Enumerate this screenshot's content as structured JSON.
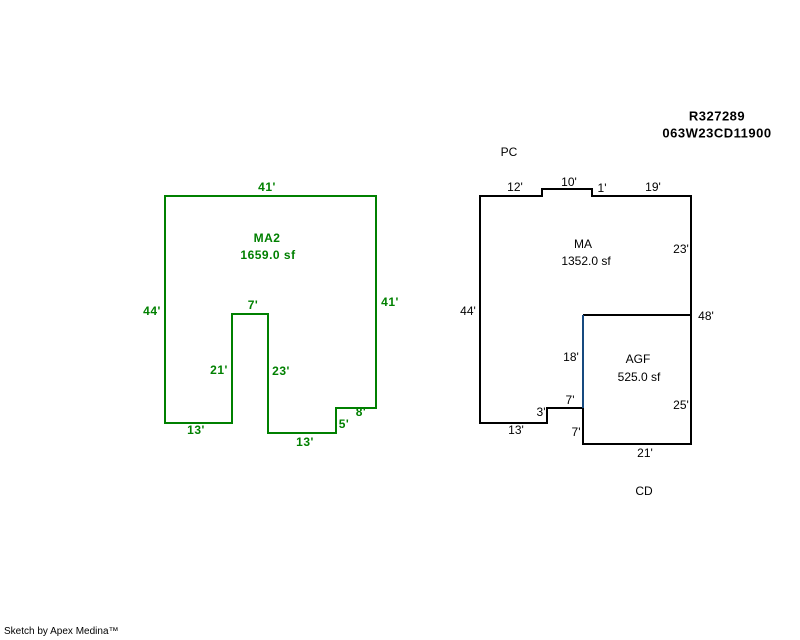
{
  "title_block": {
    "parcel_id": "R327289",
    "map_tax_lot": "063W23CD11900"
  },
  "colors": {
    "ma2_outline": "#008000",
    "ma_outline": "#000000",
    "shared_wall": "#174A7F"
  },
  "sketch_ma2": {
    "name": "MA2",
    "area": "1659.0 sf",
    "dims": {
      "top": "41'",
      "left": "44'",
      "right": "41'",
      "notch_top": "7'",
      "notch_left": "21'",
      "notch_right": "23'",
      "bottom_left": "13'",
      "bottom_mid": "13'",
      "step_height": "5'",
      "step_width": "8'"
    }
  },
  "sketch_ma": {
    "name": "MA",
    "area": "1352.0 sf",
    "label_above": "PC",
    "label_below": "CD",
    "dims": {
      "top_left": "12'",
      "bump_top": "10'",
      "bump_step": "1'",
      "top_right": "19'",
      "right_upper": "23'",
      "left": "44'",
      "right_total": "48'",
      "shared_wall": "18'",
      "notch_top": "7'",
      "notch_step": "3'",
      "bottom_left": "13'",
      "notch_side": "7'"
    }
  },
  "sketch_agf": {
    "name": "AGF",
    "area": "525.0 sf",
    "dims": {
      "right": "25'",
      "bottom": "21'"
    }
  },
  "footer": {
    "credit": "Sketch by Apex Medina™"
  }
}
